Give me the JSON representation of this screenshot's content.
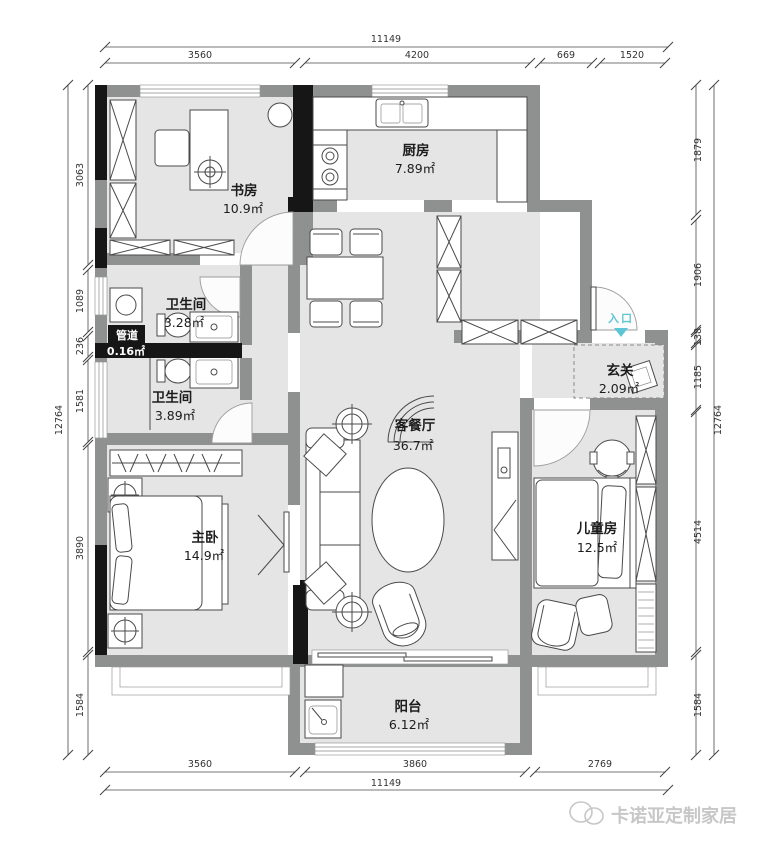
{
  "plan": {
    "rooms": [
      {
        "id": "study",
        "name": "书房",
        "area": "10.9㎡"
      },
      {
        "id": "kitchen",
        "name": "厨房",
        "area": "7.89㎡"
      },
      {
        "id": "bath-upper",
        "name": "卫生间",
        "area": "3.28㎡"
      },
      {
        "id": "duct",
        "name": "管道",
        "area": "0.16㎡"
      },
      {
        "id": "bath-lower",
        "name": "卫生间",
        "area": "3.89㎡"
      },
      {
        "id": "master-bedroom",
        "name": "主卧",
        "area": "14.9㎡"
      },
      {
        "id": "living-dining",
        "name": "客餐厅",
        "area": "36.7㎡"
      },
      {
        "id": "foyer",
        "name": "玄关",
        "area": "2.09㎡"
      },
      {
        "id": "kids-room",
        "name": "儿童房",
        "area": "12.5㎡"
      },
      {
        "id": "balcony",
        "name": "阳台",
        "area": "6.12㎡"
      }
    ],
    "entrance_label": "入口",
    "dimensions": {
      "top": {
        "overall": "11149",
        "segments": [
          "3560",
          "4200",
          "669",
          "1520"
        ]
      },
      "bottom": {
        "overall": "11149",
        "segments": [
          "3560",
          "3860",
          "2769"
        ]
      },
      "left": {
        "overall": "12764",
        "segments": [
          "3063",
          "1089",
          "236",
          "1581",
          "3890",
          "1584"
        ]
      },
      "right": {
        "overall": "12764",
        "segments": [
          "1879",
          "1906",
          "138",
          "1185",
          "4514",
          "1584"
        ]
      }
    },
    "colors": {
      "wall": "#8f9090",
      "floor": "#e4e5e4",
      "black": "#161616",
      "accent": "#5ec5d4",
      "watermark": "#c7c7c7"
    }
  },
  "watermark": {
    "text": "卡诺亚定制家居"
  }
}
